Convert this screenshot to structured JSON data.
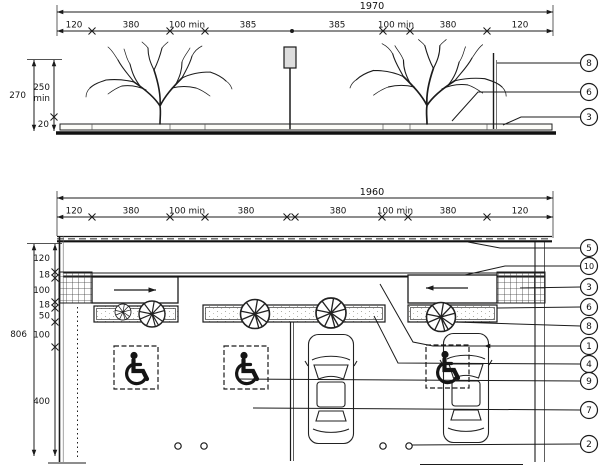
{
  "elevation": {
    "total": "1970",
    "segments": [
      "120",
      "380",
      "100 min",
      "385",
      "385",
      "100 min",
      "380",
      "120"
    ],
    "height_total": "270",
    "height_min": "250",
    "height_min_unit": "min",
    "slab_thickness": "20",
    "callouts": [
      "8",
      "6",
      "3"
    ]
  },
  "plan": {
    "total": "1960",
    "segments": [
      "120",
      "380",
      "100 min",
      "380",
      "380",
      "100 min",
      "380",
      "120"
    ],
    "depth_total": "806",
    "depth_segments": [
      "120",
      "18",
      "100",
      "18",
      "50",
      "100",
      "400"
    ],
    "callouts": [
      "5",
      "10",
      "3",
      "6",
      "8",
      "1",
      "4",
      "9",
      "7",
      "2"
    ]
  },
  "icons": {
    "wheelchair-icon": "ISA accessibility symbol",
    "tree-plan-icon": "circle with radial spokes",
    "tree-elevation-icon": "branched tree silhouette",
    "direction-arrow-icon": "arrow"
  },
  "colors": {
    "ink": "#1b1b1b",
    "paper": "#ffffff"
  }
}
